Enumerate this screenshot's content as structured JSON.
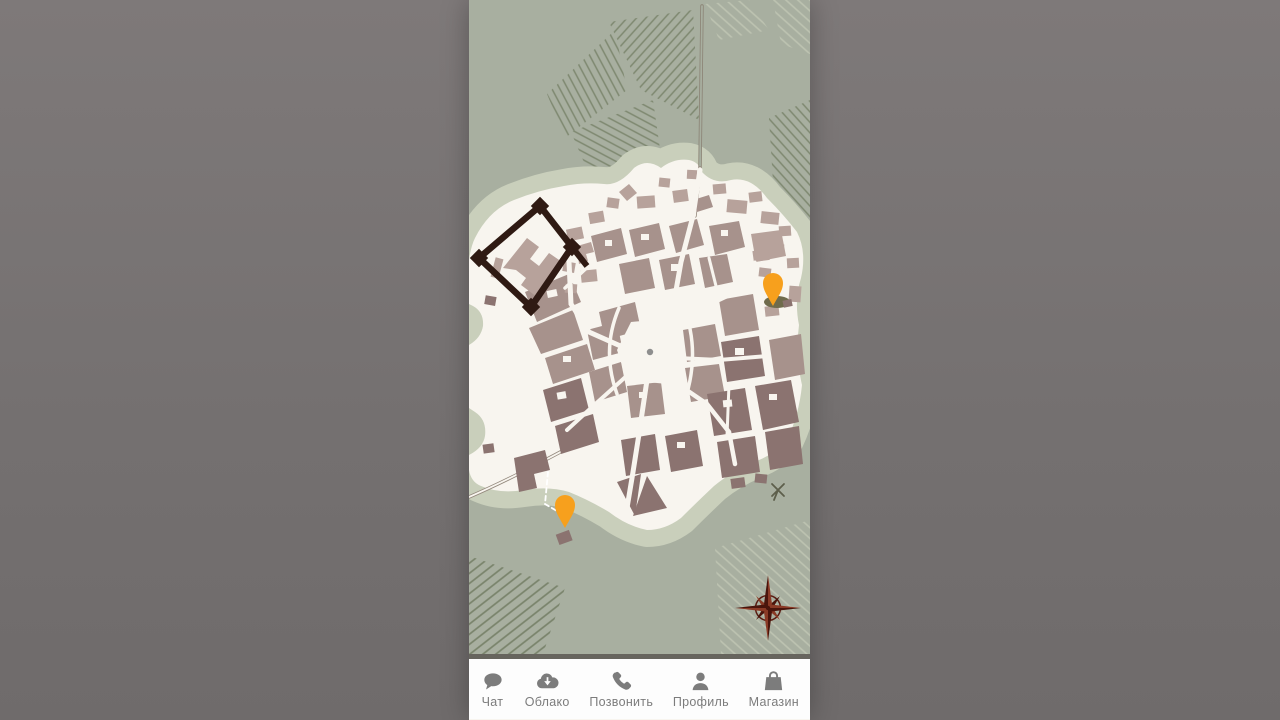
{
  "scene": {
    "type": "mobile-game-city-map",
    "orientation": "portrait-letterboxed"
  },
  "colors": {
    "letterbox": "#747070",
    "land": "#a8afa0",
    "beach": "#c9cfbb",
    "island": "#f8f5ef",
    "hatch_dark": "#7e8870",
    "hatch_light": "#bdc3b1",
    "block_light": "#b7a29b",
    "block_mid": "#a7928c",
    "block_dark": "#8b7370",
    "fort": "#2f1a13",
    "road": "#93887c",
    "pin": "#f7a01d",
    "pin_shadow": "#6f6b4c",
    "compass": "#5a1d12",
    "compass_dark": "#4a150c",
    "compass_mid": "#8a3a26",
    "plaza_dot": "#8e8e8e",
    "nav_bg": "#fdfdfd",
    "nav_fg": "#7c7c7c",
    "nav_divider": "#67655e"
  },
  "map": {
    "name": "city-map",
    "features": [
      "fortress",
      "city-blocks",
      "central-plaza",
      "hatched-fields",
      "coast-road",
      "compass-rose",
      "windmill"
    ],
    "pins": [
      {
        "name": "city-pin",
        "color": "#f7a01d"
      },
      {
        "name": "quest-pin",
        "color": "#f7a01d"
      }
    ]
  },
  "nav": {
    "items": [
      {
        "label": "Чат",
        "icon": "chat-icon"
      },
      {
        "label": "Облако",
        "icon": "cloud-download-icon"
      },
      {
        "label": "Позвонить",
        "icon": "phone-icon"
      },
      {
        "label": "Профиль",
        "icon": "profile-icon"
      },
      {
        "label": "Магазин",
        "icon": "shop-icon"
      }
    ]
  }
}
